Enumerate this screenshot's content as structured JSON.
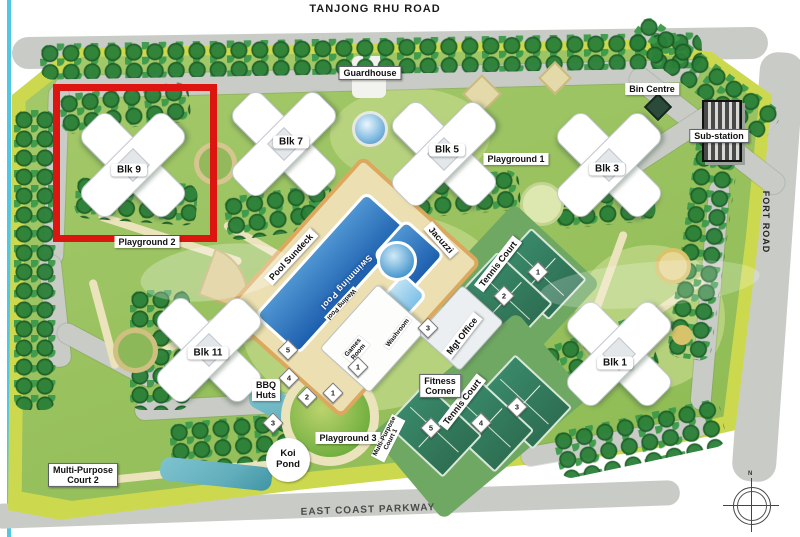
{
  "roads": {
    "top": "TANJONG RHU ROAD",
    "bottom": "EAST COAST PARKWAY",
    "right": "FORT ROAD"
  },
  "compass": {
    "north_label": "N"
  },
  "colors": {
    "red": "#dd1511",
    "pool": "#2468b8",
    "court": "#2e6f52",
    "water": "#62aebc",
    "band": "#ccd94f",
    "road": "#c9ccc6",
    "path": "#ebe3bc",
    "tree": "#2a8038"
  },
  "site": {
    "highlight": {
      "x": 53,
      "y": 84,
      "w": 150,
      "h": 144
    },
    "blocks": [
      {
        "id": "blk-9",
        "label": "Blk 9",
        "x": 132,
        "y": 164,
        "lx": 129,
        "ly": 170
      },
      {
        "id": "blk-7",
        "label": "Blk 7",
        "x": 283,
        "y": 143,
        "lx": 291,
        "ly": 142
      },
      {
        "id": "blk-5",
        "label": "Blk 5",
        "x": 443,
        "y": 153,
        "lx": 447,
        "ly": 150
      },
      {
        "id": "blk-3",
        "label": "Blk 3",
        "x": 608,
        "y": 164,
        "lx": 607,
        "ly": 169
      },
      {
        "id": "blk-1",
        "label": "Blk 1",
        "x": 618,
        "y": 353,
        "lx": 615,
        "ly": 363
      },
      {
        "id": "blk-11",
        "label": "Blk 11",
        "x": 208,
        "y": 349,
        "lx": 208,
        "ly": 353
      }
    ],
    "labels": [
      {
        "id": "guardhouse",
        "text": "Guardhouse",
        "x": 370,
        "y": 73,
        "rot": 0,
        "style": "boxed"
      },
      {
        "id": "bin-centre",
        "text": "Bin Centre",
        "x": 652,
        "y": 89,
        "rot": 0,
        "style": "plain"
      },
      {
        "id": "sub-station",
        "text": "Sub-station",
        "x": 719,
        "y": 136,
        "rot": 0,
        "style": "boxed"
      },
      {
        "id": "playground-1",
        "text": "Playground 1",
        "x": 516,
        "y": 159,
        "rot": 0,
        "style": "plain"
      },
      {
        "id": "playground-2",
        "text": "Playground 2",
        "x": 147,
        "y": 242,
        "rot": 0,
        "style": "plain"
      },
      {
        "id": "playground-3",
        "text": "Playground 3",
        "x": 348,
        "y": 438,
        "rot": 0,
        "style": "plain"
      },
      {
        "id": "pool-sundeck",
        "text": "Pool Sundeck",
        "x": 291,
        "y": 257,
        "rot": -47,
        "style": "plain"
      },
      {
        "id": "swimming-pool",
        "text": "Swimming Pool",
        "x": 346,
        "y": 282,
        "rot": 133,
        "style": "pooltext"
      },
      {
        "id": "wading-pool",
        "text": "Wading Pool",
        "x": 341,
        "y": 304,
        "rot": 133,
        "style": "tiny"
      },
      {
        "id": "jacuzzi",
        "text": "Jacuzzi",
        "x": 441,
        "y": 240,
        "rot": 48,
        "style": "plain"
      },
      {
        "id": "tennis-court-upper",
        "text": "Tennis Court",
        "x": 498,
        "y": 264,
        "rot": -52,
        "style": "plain"
      },
      {
        "id": "tennis-court-lower",
        "text": "Tennis Court",
        "x": 462,
        "y": 402,
        "rot": -52,
        "style": "plain"
      },
      {
        "id": "mgt-office",
        "text": "Mgt Office",
        "x": 462,
        "y": 336,
        "rot": -52,
        "style": "plain"
      },
      {
        "id": "fitness-corner",
        "text": "Fitness\nCorner",
        "x": 440,
        "y": 386,
        "rot": 0,
        "style": "boxed"
      },
      {
        "id": "bbq-huts",
        "text": "BBQ\nHuts",
        "x": 266,
        "y": 390,
        "rot": 0,
        "style": "plain"
      },
      {
        "id": "koi-pond",
        "text": "Koi\nPond",
        "x": 288,
        "y": 460,
        "rot": 0,
        "style": "circle"
      },
      {
        "id": "multi-purpose-court-2",
        "text": "Multi-Purpose\nCourt 2",
        "x": 83,
        "y": 475,
        "rot": 0,
        "style": "boxed"
      },
      {
        "id": "multi-purpose-court-1",
        "text": "Multi-Purpose\nCourt 1",
        "x": 388,
        "y": 438,
        "rot": -63,
        "style": "tiny"
      },
      {
        "id": "games-room",
        "text": "Games\nRoom",
        "x": 356,
        "y": 350,
        "rot": -50,
        "style": "tiny"
      },
      {
        "id": "washroom",
        "text": "Washroom",
        "x": 398,
        "y": 333,
        "rot": -52,
        "style": "tiny"
      }
    ],
    "markers": {
      "tennis": [
        {
          "n": "1",
          "x": 538,
          "y": 272
        },
        {
          "n": "2",
          "x": 504,
          "y": 296
        },
        {
          "n": "3",
          "x": 517,
          "y": 407
        },
        {
          "n": "4",
          "x": 481,
          "y": 423
        },
        {
          "n": "5",
          "x": 431,
          "y": 428
        }
      ],
      "bbq": [
        {
          "n": "1",
          "x": 333,
          "y": 393
        },
        {
          "n": "2",
          "x": 307,
          "y": 397
        },
        {
          "n": "3",
          "x": 273,
          "y": 423
        },
        {
          "n": "4",
          "x": 289,
          "y": 378
        },
        {
          "n": "5",
          "x": 288,
          "y": 350
        }
      ],
      "facility": [
        {
          "n": "1",
          "x": 358,
          "y": 367
        },
        {
          "n": "3",
          "x": 428,
          "y": 328
        }
      ]
    }
  }
}
